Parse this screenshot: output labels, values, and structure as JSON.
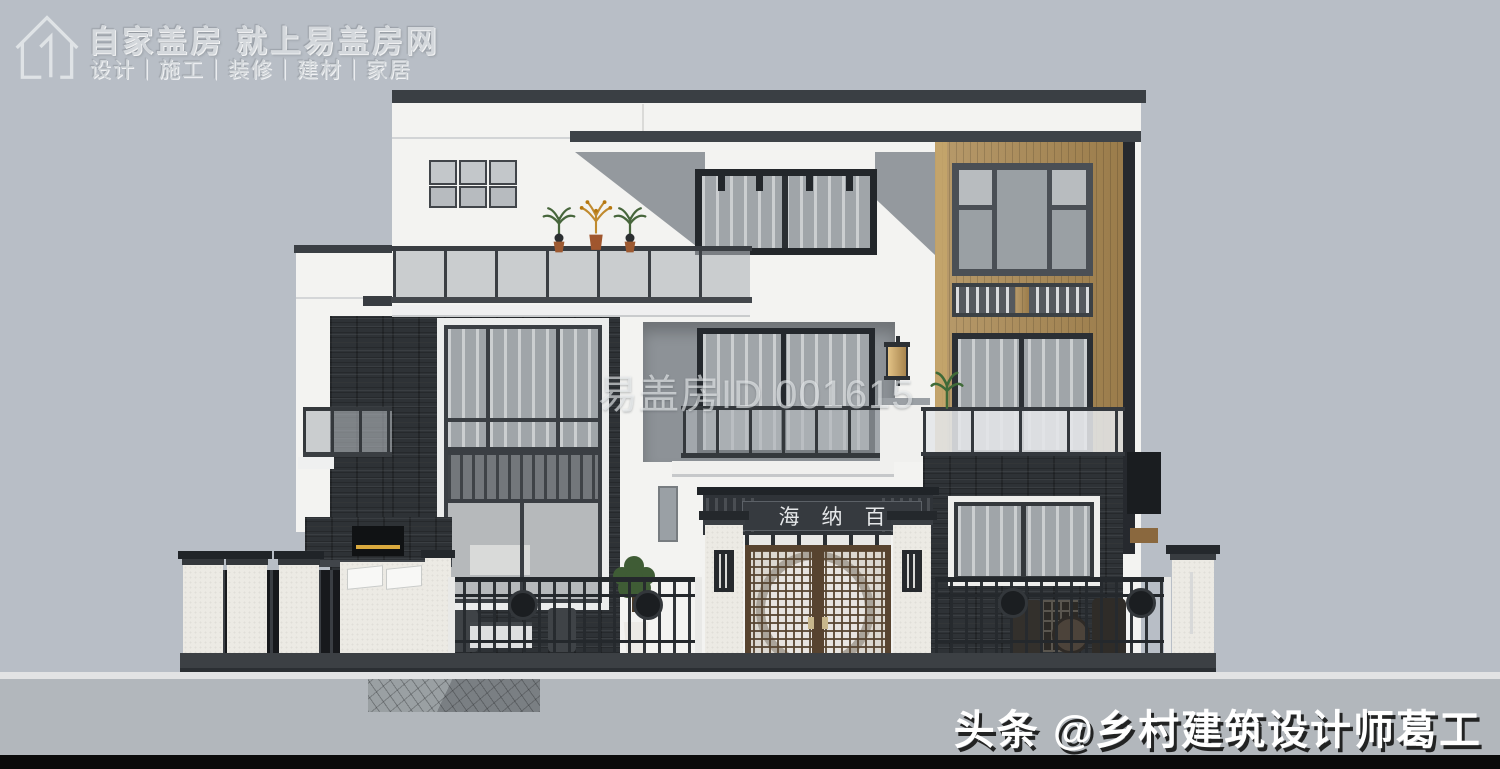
{
  "branding": {
    "title": "自家盖房 就上易盖房网",
    "subtitle": "设计｜施工｜装修｜建材｜家居",
    "logo_icon": "house-outline-with-numeral-1"
  },
  "watermark": {
    "text": "易盖房ID 001615"
  },
  "entrance": {
    "plaque": "海纳百川"
  },
  "credit": {
    "text": "头条 @乡村建筑设计师葛工"
  },
  "colors": {
    "sky": "#b8bec6",
    "ground": "#b2b7bc",
    "footer_bar": "#0a0a0a",
    "white_wall": "#f3f3f1",
    "dark_trim": "#3a3f44",
    "stone": "#2e3236",
    "wood": "#ac8a53",
    "lantern_amber": "#d8b87c",
    "warm_light": "#d9a93e",
    "plant_green": "#47663c",
    "flower_orange": "#c08a2e",
    "door_brown": "#57432f"
  }
}
